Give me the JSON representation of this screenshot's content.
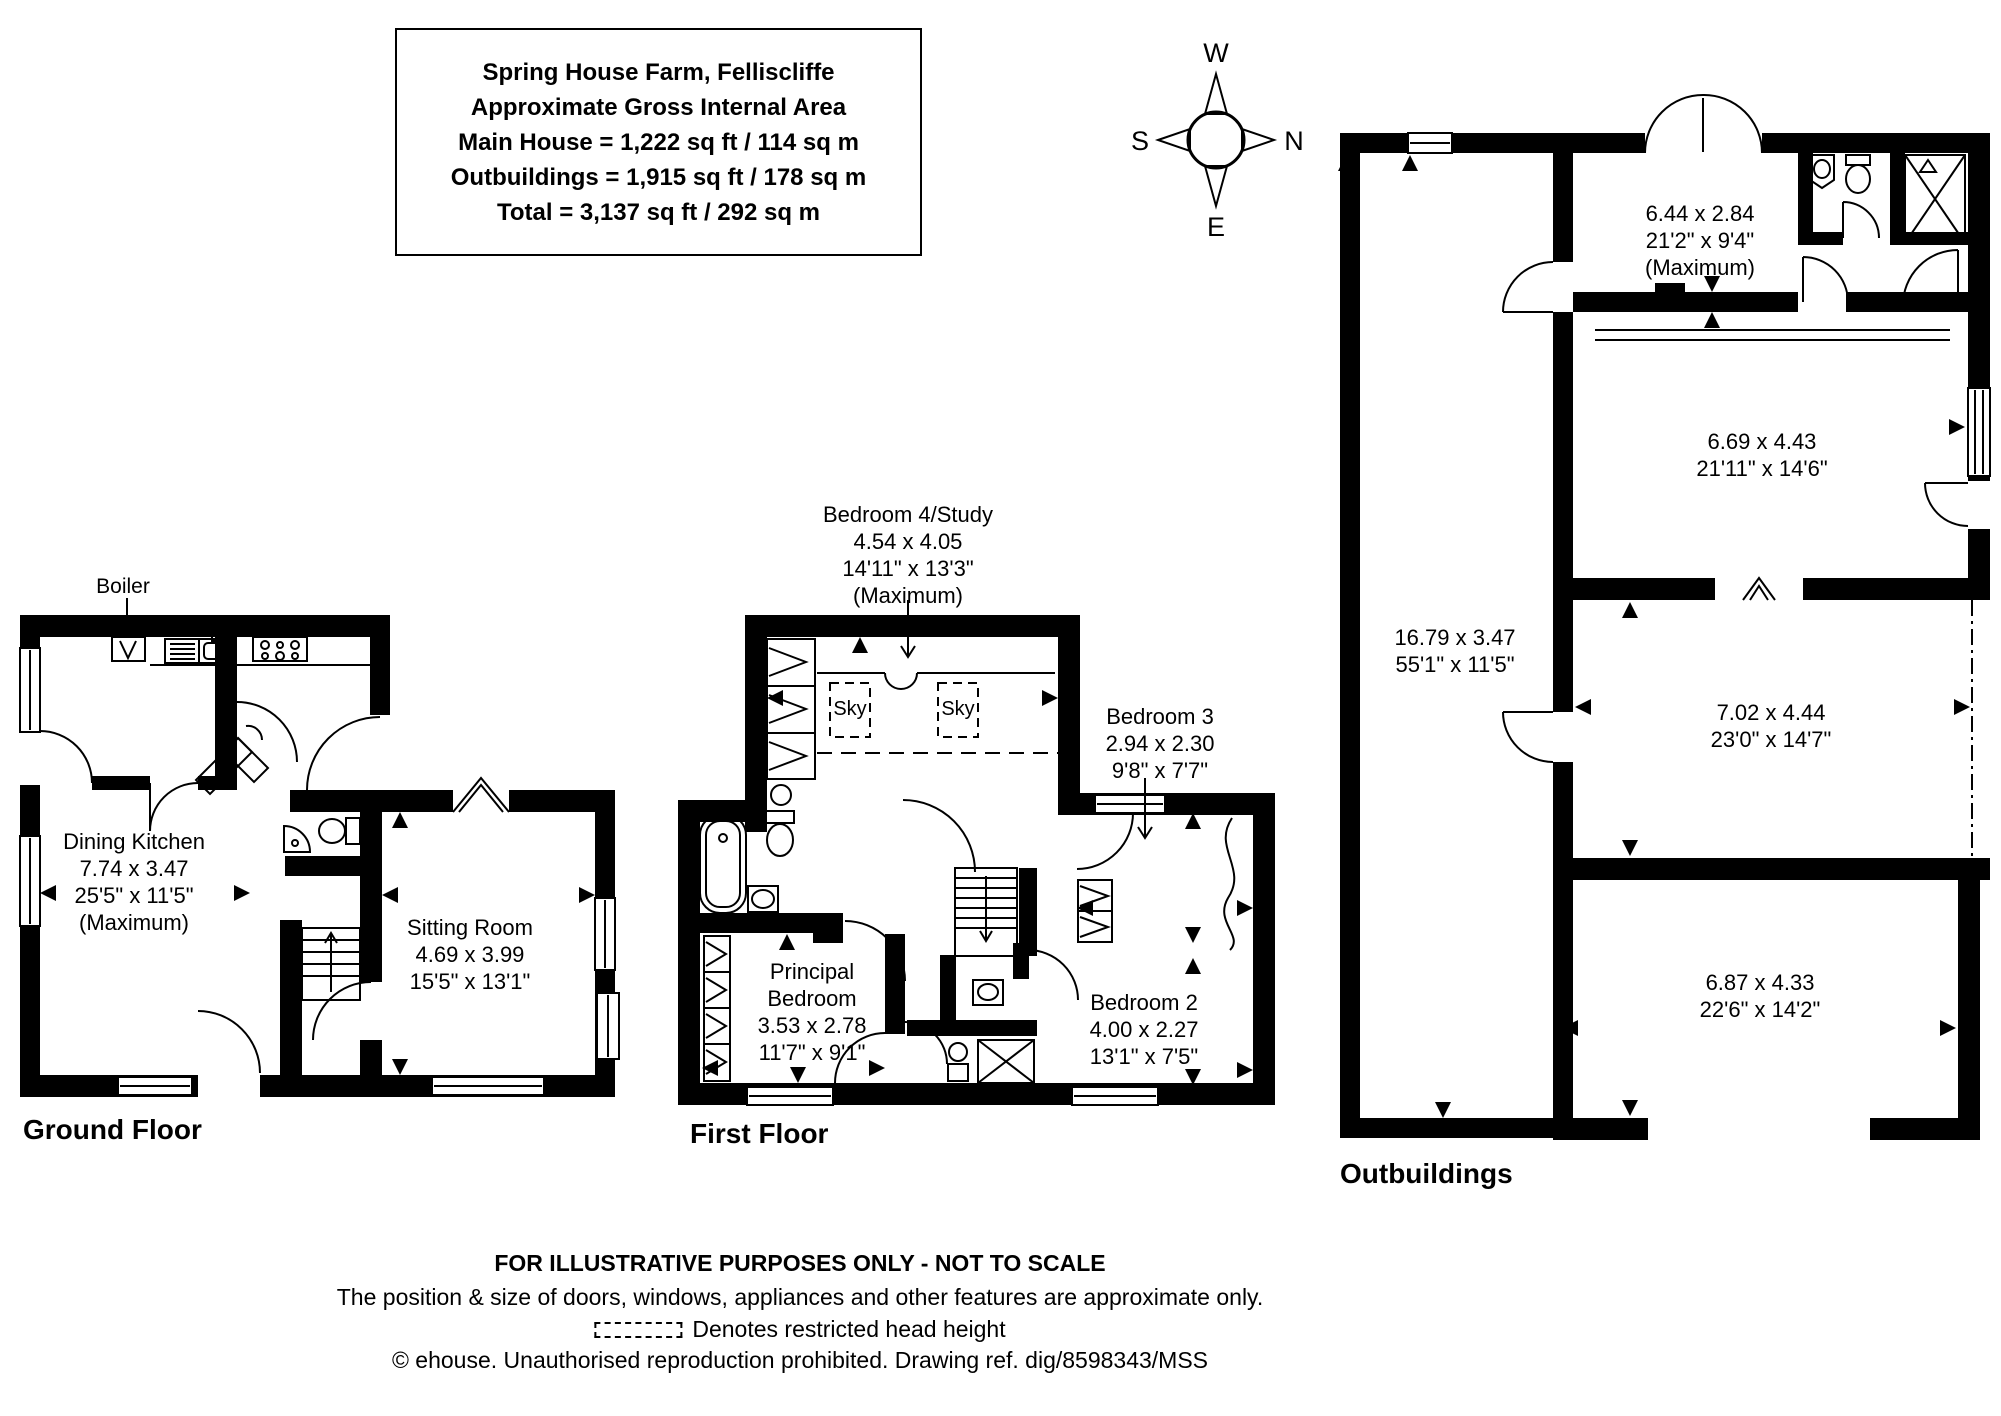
{
  "title_block": {
    "line1": "Spring House Farm, Felliscliffe",
    "line2": "Approximate Gross Internal Area",
    "line3": "Main House = 1,222 sq ft / 114 sq m",
    "line4": "Outbuildings = 1,915 sq ft / 178 sq m",
    "line5": "Total = 3,137 sq ft / 292 sq m"
  },
  "compass": {
    "west": "W",
    "north": "N",
    "east": "E",
    "south": "S"
  },
  "ground_floor": {
    "label": "Ground Floor",
    "boiler_label": "Boiler",
    "rooms": {
      "dining_kitchen": {
        "name": "Dining Kitchen",
        "metric": "7.74 x 3.47",
        "imperial": "25'5\" x 11'5\"",
        "note": "(Maximum)"
      },
      "sitting_room": {
        "name": "Sitting Room",
        "metric": "4.69 x 3.99",
        "imperial": "15'5\" x 13'1\""
      }
    }
  },
  "first_floor": {
    "label": "First Floor",
    "skylight_label": "Sky",
    "rooms": {
      "bedroom4_study": {
        "name": "Bedroom 4/Study",
        "metric": "4.54 x 4.05",
        "imperial": "14'11\" x 13'3\"",
        "note": "(Maximum)"
      },
      "bedroom3": {
        "name": "Bedroom 3",
        "metric": "2.94 x 2.30",
        "imperial": "9'8\" x 7'7\""
      },
      "principal_bedroom": {
        "name": "Principal Bedroom",
        "metric": "3.53 x 2.78",
        "imperial": "11'7\" x 9'1\""
      },
      "bedroom2": {
        "name": "Bedroom 2",
        "metric": "4.00 x 2.27",
        "imperial": "13'1\" x 7'5\""
      }
    }
  },
  "outbuildings": {
    "label": "Outbuildings",
    "rooms": {
      "top_store": {
        "metric": "6.44 x 2.84",
        "imperial": "21'2\" x 9'4\"",
        "note": "(Maximum)"
      },
      "upper_barn": {
        "metric": "6.69 x 4.43",
        "imperial": "21'11\" x 14'6\""
      },
      "long_store": {
        "metric": "16.79 x 3.47",
        "imperial": "55'1\" x 11'5\""
      },
      "middle_barn": {
        "metric": "7.02 x 4.44",
        "imperial": "23'0\" x 14'7\""
      },
      "lower_barn": {
        "metric": "6.87 x 4.33",
        "imperial": "22'6\" x 14'2\""
      }
    }
  },
  "footer": {
    "disclaimer": "FOR ILLUSTRATIVE PURPOSES ONLY - NOT TO SCALE",
    "approx_note": "The position & size of doors, windows, appliances and other features are approximate only.",
    "restricted_note": "Denotes restricted head height",
    "copyright": "© ehouse. Unauthorised reproduction prohibited. Drawing ref. dig/8598343/MSS"
  }
}
